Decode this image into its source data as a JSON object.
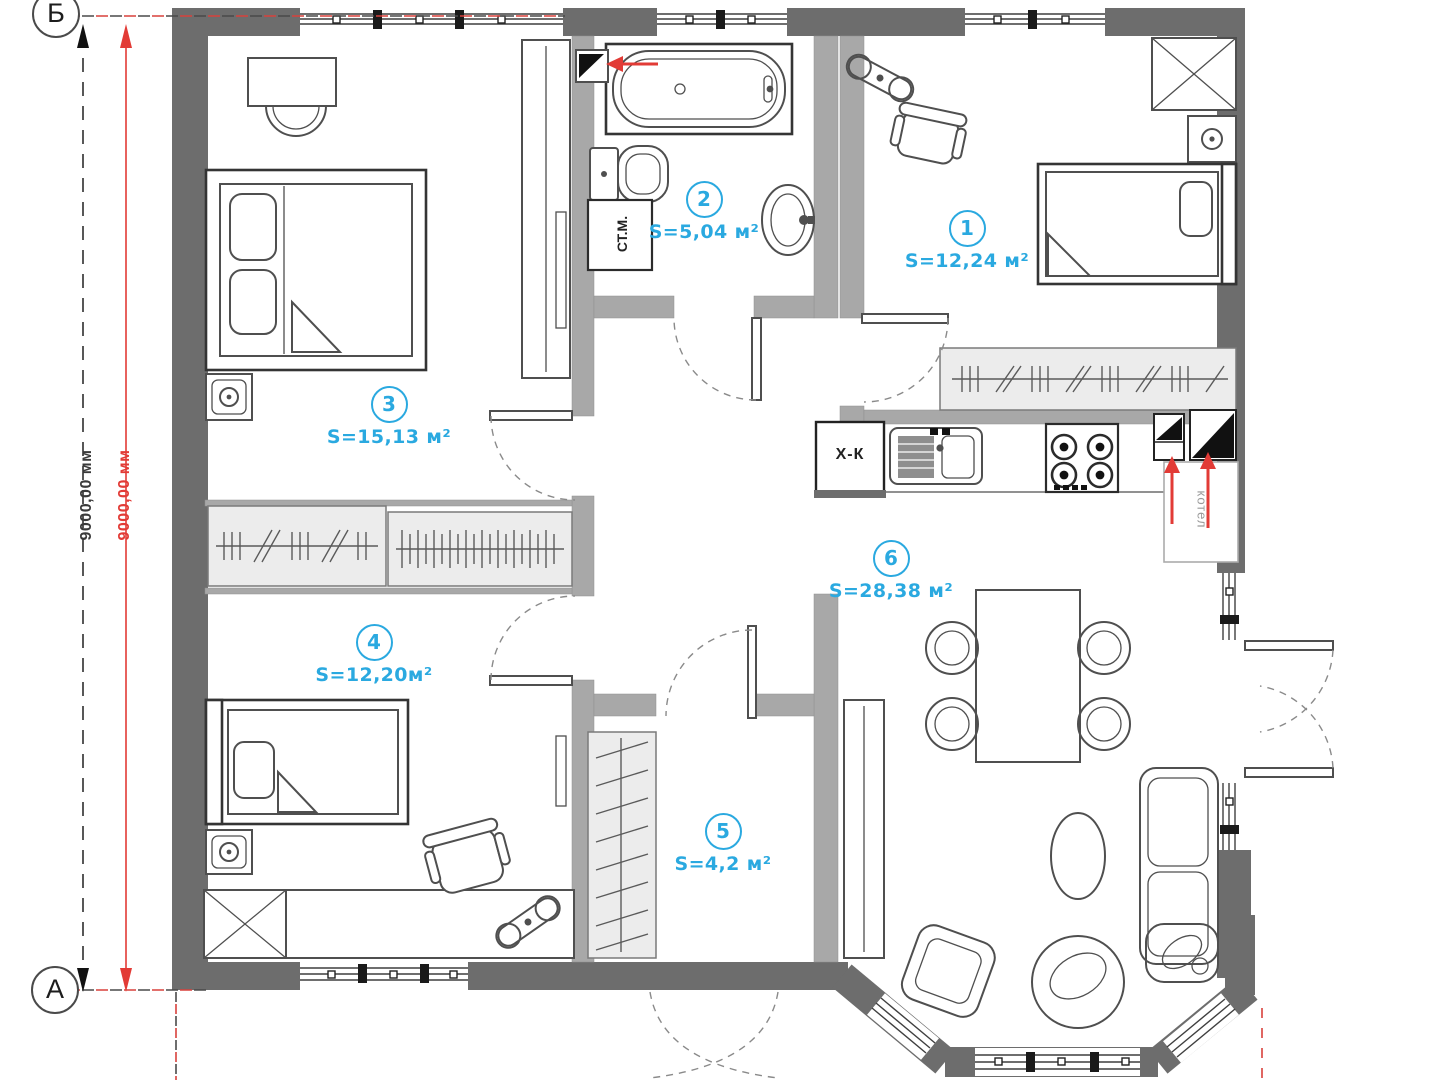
{
  "plan": {
    "axis_markers": {
      "top": "Б",
      "bottom": "А"
    },
    "dimension_labels": {
      "outer_black": "9000,00 мм",
      "inner_red": "9000,00 мм"
    },
    "rooms": [
      {
        "number": "1",
        "area": "S=12,24 м²"
      },
      {
        "number": "2",
        "area": "S=5,04 м²"
      },
      {
        "number": "3",
        "area": "S=15,13 м²"
      },
      {
        "number": "4",
        "area": "S=12,20м²"
      },
      {
        "number": "5",
        "area": "S=4,2 м²"
      },
      {
        "number": "6",
        "area": "S=28,38 м²"
      }
    ],
    "equipment": {
      "washing_machine": "СТ.М.",
      "fridge": "Х-К",
      "boiler": "котел"
    },
    "colors": {
      "wall": "#6d6d6d",
      "partition": "#a8a8a8",
      "room_label": "#2aa9e0",
      "dimension_red": "#e23b36",
      "furniture_line": "#4f4f4f"
    }
  }
}
